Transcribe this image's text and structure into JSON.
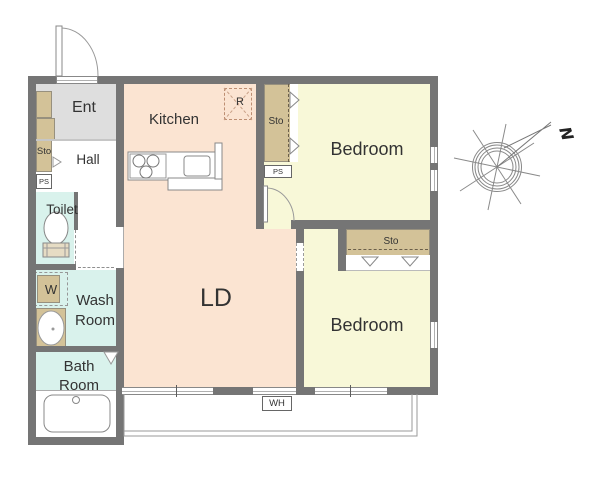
{
  "palette": {
    "wall": "#757575",
    "floor-living": "#fbe4d2",
    "floor-bedroom": "#f8f8d8",
    "floor-wet": "#d9f2ec",
    "floor-entrance": "#dedede",
    "storage": "#d3c298",
    "balcony-line": "#9a9a9a",
    "text": "#333333"
  },
  "rooms": {
    "ent": "Ent",
    "kitchen": "Kitchen",
    "hall": "Hall",
    "toilet": "Toilet",
    "wash_room": "Wash Room",
    "bath_room": "Bath Room",
    "ld": "LD",
    "bedroom_top": "Bedroom",
    "bedroom_bottom": "Bedroom"
  },
  "labels": {
    "storage_hall": "Sto",
    "storage_bedroom_top": "Sto",
    "storage_bedroom_bottom": "Sto",
    "pipe_space_hall": "PS",
    "pipe_space_bedroom": "PS",
    "refrigerator": "R",
    "washer": "W",
    "water_heater": "WH"
  },
  "compass": {
    "north": "N"
  }
}
